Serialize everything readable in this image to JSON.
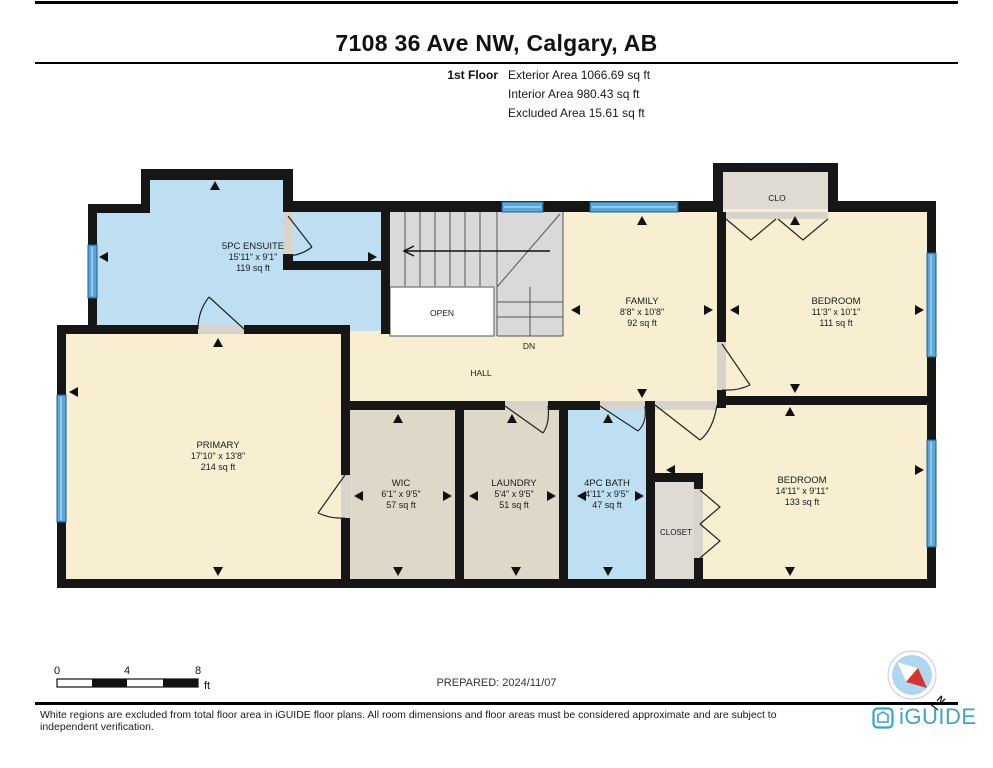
{
  "page": {
    "title": "7108 36 Ave NW, Calgary, AB",
    "floor_label": "1st Floor",
    "areas": [
      "Exterior Area 1066.69 sq ft",
      "Interior Area 980.43 sq ft",
      "Excluded Area 15.61 sq ft"
    ]
  },
  "plan": {
    "rooms": {
      "ensuite": {
        "name": "5PC ENSUITE",
        "dims": "15'11\" x 9'1\"",
        "area": "119 sq ft"
      },
      "primary": {
        "name": "PRIMARY",
        "dims": "17'10\" x 13'8\"",
        "area": "214 sq ft"
      },
      "wic": {
        "name": "WIC",
        "dims": "6'1\" x 9'5\"",
        "area": "57 sq ft"
      },
      "laundry": {
        "name": "LAUNDRY",
        "dims": "5'4\" x 9'5\"",
        "area": "51 sq ft"
      },
      "bath": {
        "name": "4PC BATH",
        "dims": "4'11\" x 9'5\"",
        "area": "47 sq ft"
      },
      "family": {
        "name": "FAMILY",
        "dims": "8'8\" x 10'8\"",
        "area": "92 sq ft"
      },
      "bedroom1": {
        "name": "BEDROOM",
        "dims": "11'3\" x 10'1\"",
        "area": "111 sq ft"
      },
      "bedroom2": {
        "name": "BEDROOM",
        "dims": "14'11\" x 9'11\"",
        "area": "133 sq ft"
      },
      "clo": {
        "name": "CLO"
      },
      "closet": {
        "name": "CLOSET"
      },
      "hall": {
        "name": "HALL"
      },
      "open": {
        "name": "OPEN"
      },
      "down": {
        "name": "DN"
      }
    },
    "colors": {
      "room_cream": "#F8EFD3",
      "room_blue": "#BEDFF2",
      "room_tan": "#DED8C8",
      "closet_gray": "#DFDBD4",
      "stairs_gray": "#D9D9D9",
      "window_blue": "#58A8DA",
      "wall_black": "#161616",
      "brand_blue": "#3BA4CB",
      "compass_red": "#D63230"
    }
  },
  "scale_bar": {
    "labels": [
      "0",
      "4",
      "8"
    ],
    "unit": "ft"
  },
  "compass": {
    "label": "N"
  },
  "footer": {
    "prepared": "PREPARED: 2024/11/07",
    "disclaimer": "White regions are excluded from total floor area in iGUIDE floor plans. All room dimensions and floor areas must be considered approximate and are subject to independent verification.",
    "brand": "iGUIDE"
  }
}
